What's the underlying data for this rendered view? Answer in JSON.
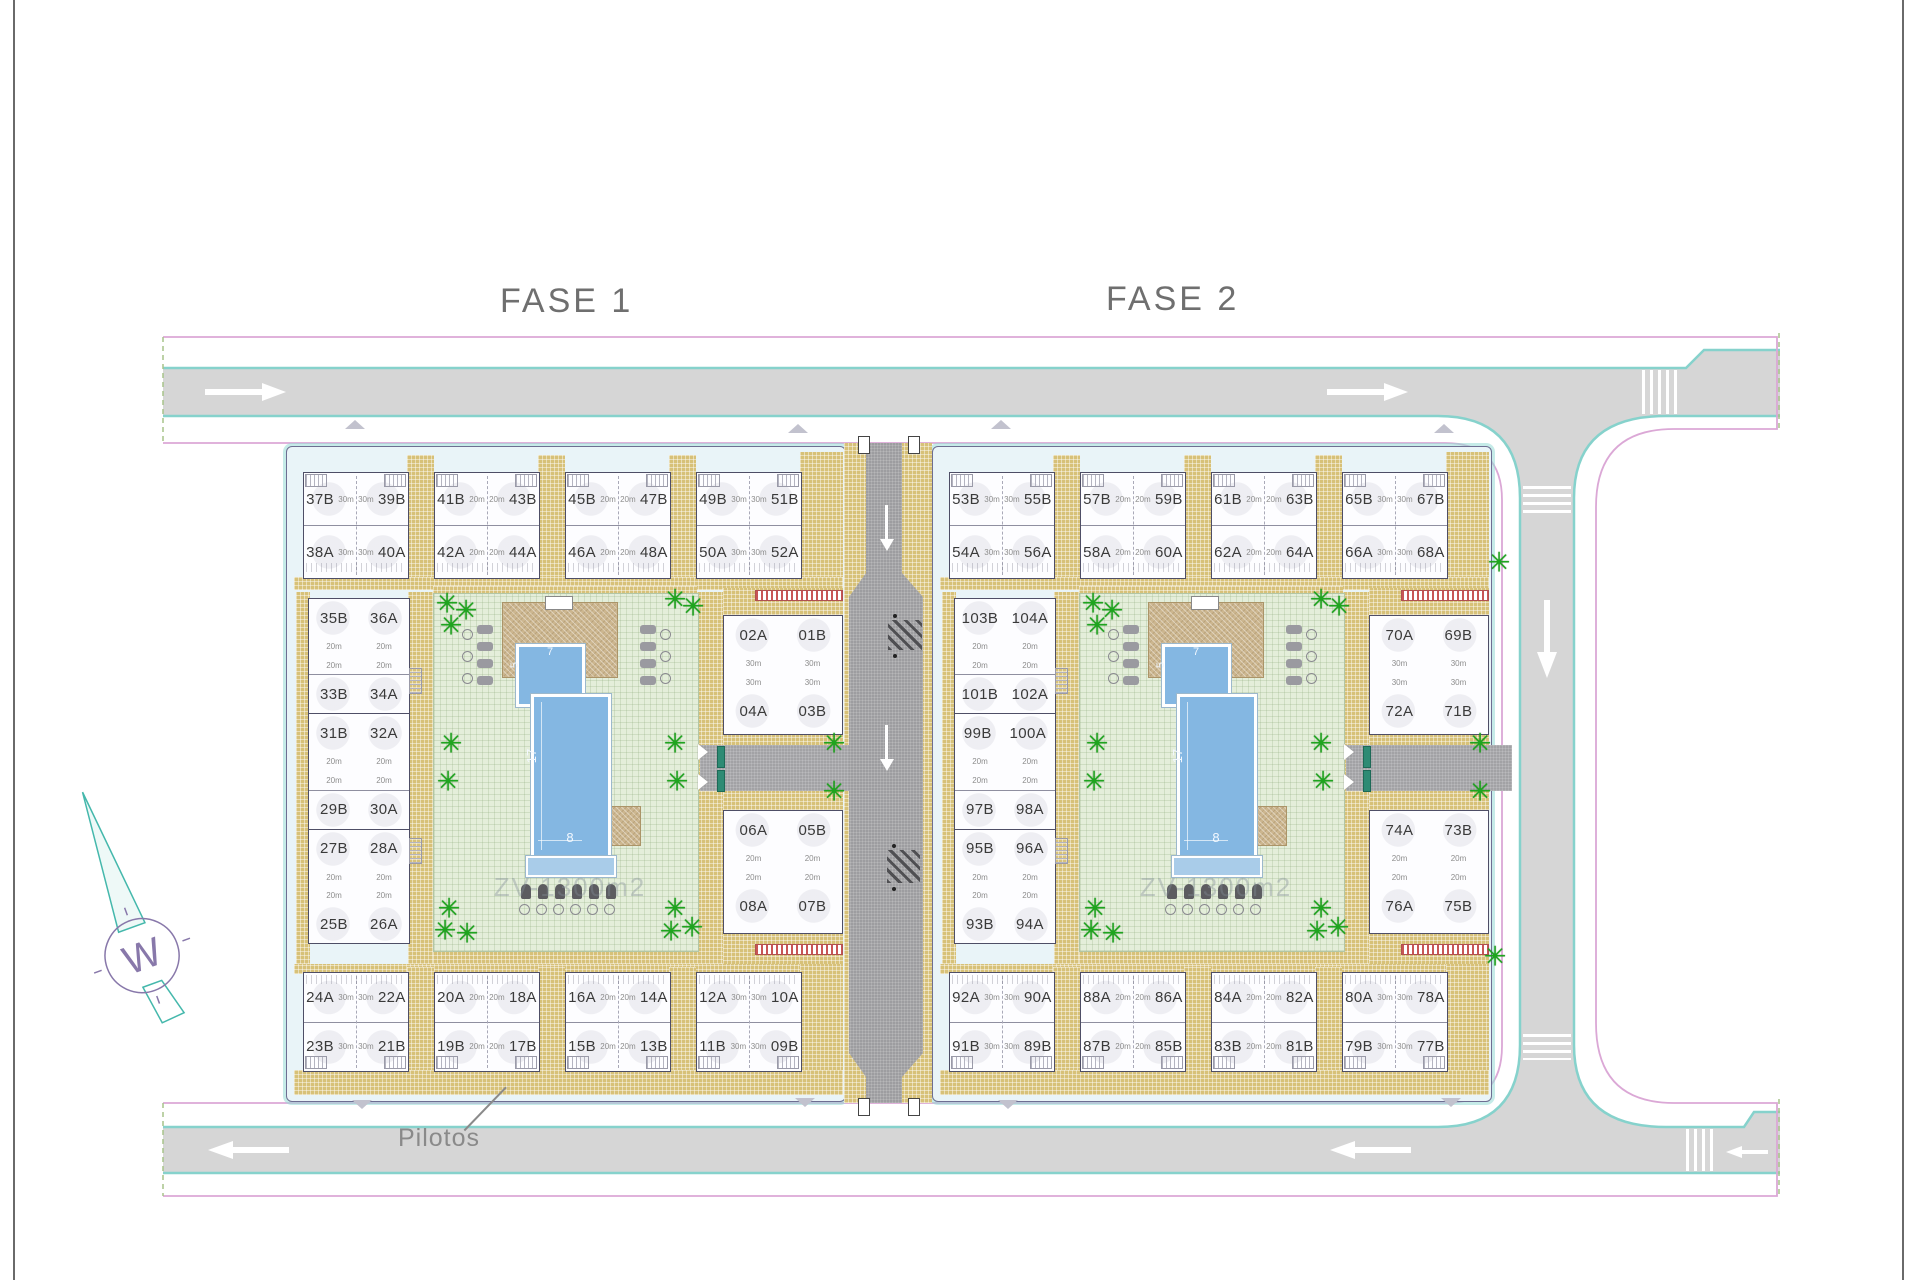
{
  "sheet": {
    "title_fase1": "FASE 1",
    "title_fase2": "FASE 2",
    "pilotos_label": "Pilotos",
    "watermark": "ZV-1300m2",
    "compass_letter": "W"
  },
  "pool_labels": {
    "length": "17",
    "width": "8",
    "small_height": "5",
    "small_width": "7"
  },
  "colors": {
    "road_gray": "#d6d6d6",
    "central_road_gray": "#9d9da0",
    "curb_cyan": "#86d2cc",
    "boundary_pink": "#dba8d6",
    "paving_tan": "#d7c178",
    "courtyard_green": "#e4eeda",
    "pool_blue": "#84b7e2",
    "tree_green": "#1ea51e",
    "red_band": "#c85555",
    "text_gray": "#6f6f6f"
  },
  "phases": [
    {
      "name": "FASE 1",
      "top_row": [
        {
          "b": [
            "37B",
            "39B"
          ],
          "a": [
            "38A",
            "40A"
          ],
          "area": "30m"
        },
        {
          "b": [
            "41B",
            "43B"
          ],
          "a": [
            "42A",
            "44A"
          ],
          "area": "20m"
        },
        {
          "b": [
            "45B",
            "47B"
          ],
          "a": [
            "46A",
            "48A"
          ],
          "area": "20m"
        },
        {
          "b": [
            "49B",
            "51B"
          ],
          "a": [
            "50A",
            "52A"
          ],
          "area": "30m"
        }
      ],
      "side_column": [
        [
          "35B",
          "36A"
        ],
        [
          "33B",
          "34A"
        ],
        [
          "31B",
          "32A"
        ],
        [
          "29B",
          "30A"
        ],
        [
          "27B",
          "28A"
        ],
        [
          "25B",
          "26A"
        ]
      ],
      "side_area": "20m",
      "mid_top": {
        "rows": [
          [
            "02A",
            "01B"
          ],
          [
            "04A",
            "03B"
          ]
        ],
        "area": "30m"
      },
      "mid_bottom": {
        "rows": [
          [
            "06A",
            "05B"
          ],
          [
            "08A",
            "07B"
          ]
        ],
        "area": "20m"
      },
      "bottom_row": [
        {
          "a": [
            "24A",
            "22A"
          ],
          "b": [
            "23B",
            "21B"
          ],
          "area": "30m"
        },
        {
          "a": [
            "20A",
            "18A"
          ],
          "b": [
            "19B",
            "17B"
          ],
          "area": "20m"
        },
        {
          "a": [
            "16A",
            "14A"
          ],
          "b": [
            "15B",
            "13B"
          ],
          "area": "20m"
        },
        {
          "a": [
            "12A",
            "10A"
          ],
          "b": [
            "11B",
            "09B"
          ],
          "area": "30m"
        }
      ]
    },
    {
      "name": "FASE 2",
      "top_row": [
        {
          "b": [
            "53B",
            "55B"
          ],
          "a": [
            "54A",
            "56A"
          ],
          "area": "30m"
        },
        {
          "b": [
            "57B",
            "59B"
          ],
          "a": [
            "58A",
            "60A"
          ],
          "area": "20m"
        },
        {
          "b": [
            "61B",
            "63B"
          ],
          "a": [
            "62A",
            "64A"
          ],
          "area": "20m"
        },
        {
          "b": [
            "65B",
            "67B"
          ],
          "a": [
            "66A",
            "68A"
          ],
          "area": "30m"
        }
      ],
      "side_column": [
        [
          "103B",
          "104A"
        ],
        [
          "101B",
          "102A"
        ],
        [
          "99B",
          "100A"
        ],
        [
          "97B",
          "98A"
        ],
        [
          "95B",
          "96A"
        ],
        [
          "93B",
          "94A"
        ]
      ],
      "side_area": "20m",
      "mid_top": {
        "rows": [
          [
            "70A",
            "69B"
          ],
          [
            "72A",
            "71B"
          ]
        ],
        "area": "30m"
      },
      "mid_bottom": {
        "rows": [
          [
            "74A",
            "73B"
          ],
          [
            "76A",
            "75B"
          ]
        ],
        "area": "20m"
      },
      "bottom_row": [
        {
          "a": [
            "92A",
            "90A"
          ],
          "b": [
            "91B",
            "89B"
          ],
          "area": "30m"
        },
        {
          "a": [
            "88A",
            "86A"
          ],
          "b": [
            "87B",
            "85B"
          ],
          "area": "20m"
        },
        {
          "a": [
            "84A",
            "82A"
          ],
          "b": [
            "83B",
            "81B"
          ],
          "area": "20m"
        },
        {
          "a": [
            "80A",
            "78A"
          ],
          "b": [
            "79B",
            "77B"
          ],
          "area": "30m"
        }
      ]
    }
  ]
}
